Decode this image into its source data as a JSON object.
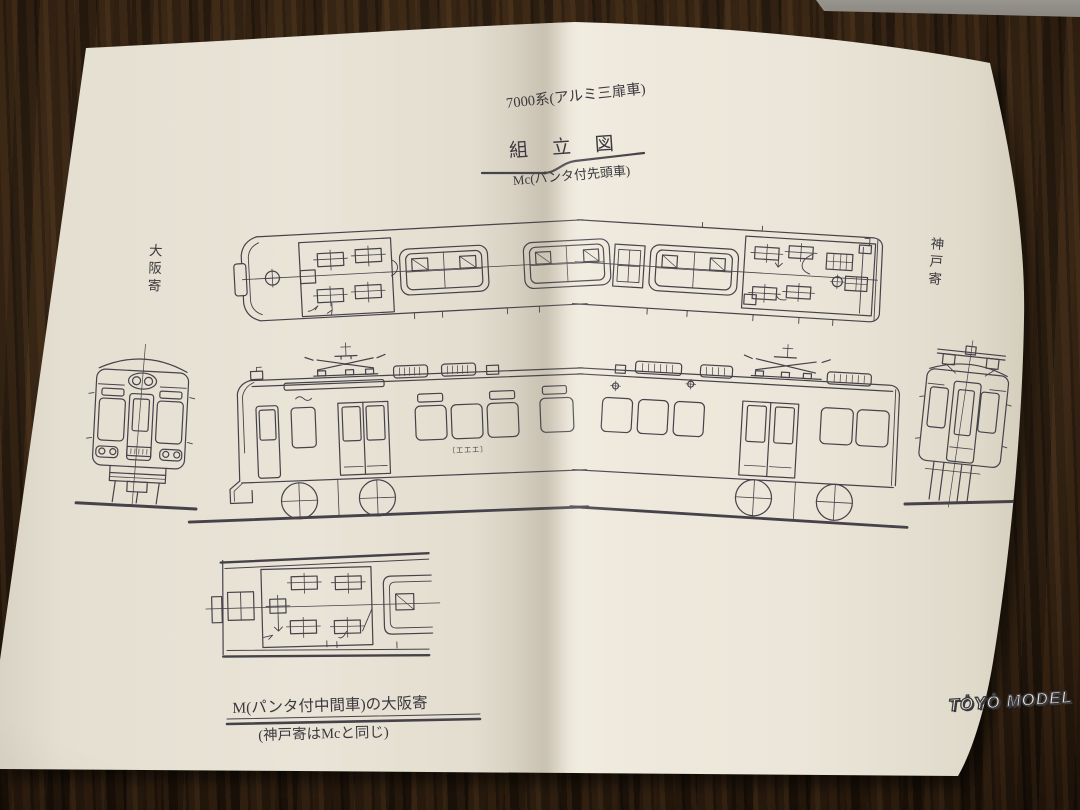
{
  "page": {
    "series_title": "7000系(アルミ三扉車)",
    "assembly_title": "組立図",
    "subtitle": "Mc(パンタ付先頭車)",
    "label_osaka": "大阪寄",
    "label_kobe": "神戸寄",
    "caption_line1": "M(パンタ付中間車)の大阪寄",
    "caption_line2": "(神戸寄はMcと同じ)",
    "logo_text": "TȮYȮ MODEL",
    "emblem_marks": "〔工工工〕"
  },
  "colors": {
    "paper": "#e9e4d7",
    "ink": "#45424a",
    "wood": "#2b1a0d",
    "table_edge": "#8d8a84"
  }
}
